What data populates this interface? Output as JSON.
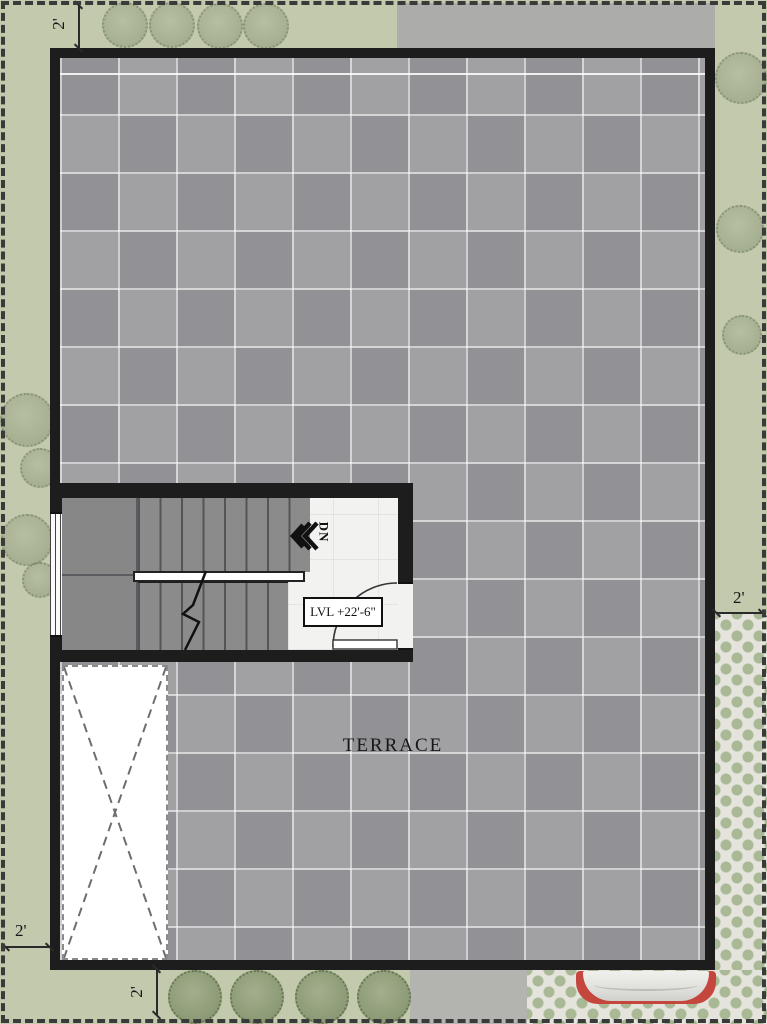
{
  "plan": {
    "name": "Terrace Floor Plan",
    "area_label": "TERRACE",
    "level_label": "LVL +22'-6\"",
    "stair_direction_label": "DN",
    "dimensions": {
      "top_left": "2'",
      "bottom_left": "2'",
      "bottom_center": "2'",
      "right": "2'"
    },
    "colors": {
      "lawn": "#c3c9ad",
      "concrete": "#acacaa",
      "wall": "#1d1d1d",
      "tile": "#9b9b9e",
      "tread": "#8b8b8b",
      "landing": "#f2f2f0",
      "paver_green": "#a9b895",
      "paver_base": "#e4e4dd",
      "car_red": "#c4463d"
    }
  }
}
